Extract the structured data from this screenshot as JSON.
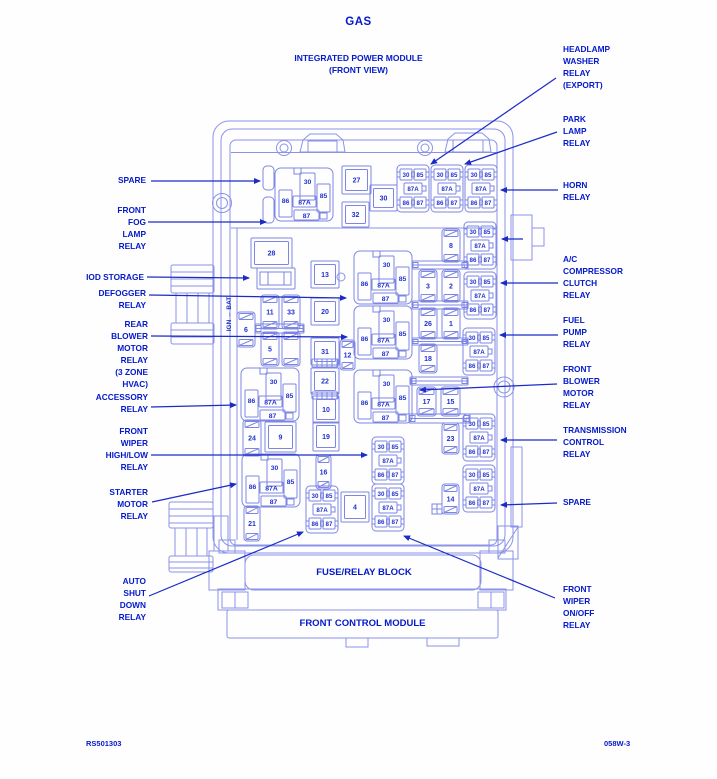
{
  "header": {
    "title": "GAS",
    "subtitle1": "INTEGRATED POWER MODULE",
    "subtitle2": "(FRONT VIEW)"
  },
  "panels": {
    "fuse_relay_block": "FUSE/RELAY BLOCK",
    "front_control_module": "FRONT CONTROL MODULE"
  },
  "footer": {
    "left": "RS501303",
    "right": "058W-3"
  },
  "colors": {
    "label_text": "#0419c9",
    "pin_text": "#2132cc",
    "line_light": "#8a93e6",
    "line_medium": "#7d86e3",
    "leader": "#1b2bc6",
    "background": "#fefeff"
  },
  "diagram": {
    "ign_bat_label": "IGN ↔ BAT",
    "left_labels": [
      {
        "id": "spare-left",
        "lines": [
          "SPARE"
        ],
        "x": 146,
        "y": 175,
        "leader": [
          151,
          181,
          260,
          181
        ]
      },
      {
        "id": "front-fog-lamp-relay",
        "lines": [
          "FRONT",
          "FOG",
          "LAMP",
          "RELAY"
        ],
        "x": 146,
        "y": 205,
        "leader": [
          148,
          222,
          266,
          222
        ]
      },
      {
        "id": "iod-storage",
        "lines": [
          "IOD STORAGE"
        ],
        "x": 144,
        "y": 272,
        "leader": [
          147,
          277,
          249,
          278
        ]
      },
      {
        "id": "defogger-relay",
        "lines": [
          "DEFOGGER",
          "RELAY"
        ],
        "x": 146,
        "y": 288,
        "leader": [
          149,
          295,
          346,
          298
        ]
      },
      {
        "id": "rear-blower-motor",
        "lines": [
          "REAR",
          "BLOWER",
          "MOTOR",
          "RELAY",
          "(3 ZONE",
          "HVAC)"
        ],
        "x": 148,
        "y": 319,
        "leader": [
          151,
          336,
          347,
          337
        ]
      },
      {
        "id": "accessory-relay",
        "lines": [
          "ACCESSORY",
          "RELAY"
        ],
        "x": 148,
        "y": 392,
        "leader": [
          151,
          407,
          236,
          405
        ]
      },
      {
        "id": "front-wiper-highlow",
        "lines": [
          "FRONT",
          "WIPER",
          "HIGH/LOW",
          "RELAY"
        ],
        "x": 148,
        "y": 426,
        "leader": [
          151,
          455,
          367,
          455
        ]
      },
      {
        "id": "starter-motor-relay",
        "lines": [
          "STARTER",
          "MOTOR",
          "RELAY"
        ],
        "x": 148,
        "y": 487,
        "leader": [
          152,
          502,
          236,
          484
        ]
      },
      {
        "id": "auto-shut-down-relay",
        "lines": [
          "AUTO",
          "SHUT",
          "DOWN",
          "RELAY"
        ],
        "x": 146,
        "y": 576,
        "leader": [
          149,
          596,
          303,
          532
        ]
      }
    ],
    "right_labels": [
      {
        "id": "headlamp-washer-relay",
        "lines": [
          "HEADLAMP",
          "WASHER",
          "RELAY",
          "(EXPORT)"
        ],
        "x": 563,
        "y": 44,
        "leader": [
          556,
          78,
          431,
          164
        ]
      },
      {
        "id": "park-lamp-relay",
        "lines": [
          "PARK",
          "LAMP",
          "RELAY"
        ],
        "x": 563,
        "y": 114,
        "leader": [
          557,
          132,
          465,
          164
        ]
      },
      {
        "id": "horn-relay",
        "lines": [
          "HORN",
          "RELAY"
        ],
        "x": 563,
        "y": 180,
        "leader": [
          558,
          190,
          501,
          190
        ]
      },
      {
        "id": "ac-compressor-clutch",
        "lines": [
          "A/C",
          "COMPRESSOR",
          "CLUTCH",
          "RELAY"
        ],
        "x": 563,
        "y": 254,
        "leader": [
          558,
          283,
          501,
          283
        ]
      },
      {
        "id": "fuel-pump-relay",
        "lines": [
          "FUEL",
          "PUMP",
          "RELAY"
        ],
        "x": 563,
        "y": 315,
        "leader": [
          558,
          335,
          500,
          335
        ]
      },
      {
        "id": "front-blower-motor",
        "lines": [
          "FRONT",
          "BLOWER",
          "MOTOR",
          "RELAY"
        ],
        "x": 563,
        "y": 364,
        "leader": [
          557,
          384,
          420,
          390
        ]
      },
      {
        "id": "transmission-control",
        "lines": [
          "TRANSMISSION",
          "CONTROL",
          "RELAY"
        ],
        "x": 563,
        "y": 425,
        "leader": [
          557,
          440,
          501,
          440
        ]
      },
      {
        "id": "spare-right",
        "lines": [
          "SPARE"
        ],
        "x": 563,
        "y": 497,
        "leader": [
          557,
          503,
          501,
          505
        ]
      },
      {
        "id": "front-wiper-onoff",
        "lines": [
          "FRONT",
          "WIPER",
          "ON/OFF",
          "RELAY"
        ],
        "x": 563,
        "y": 584,
        "leader": [
          555,
          598,
          404,
          536
        ]
      }
    ],
    "extra_leaders": [
      [
        523,
        239,
        502,
        239
      ]
    ],
    "square_fuses": [
      [
        "27",
        342,
        166,
        29,
        28
      ],
      [
        "32",
        342,
        202,
        27,
        25
      ],
      [
        "30",
        370,
        185,
        27,
        26
      ],
      [
        "28",
        251,
        238,
        41,
        30
      ],
      [
        "13",
        311,
        261,
        28,
        27
      ],
      [
        "20",
        311,
        298,
        28,
        27
      ],
      [
        "31",
        311,
        338,
        28,
        27
      ],
      [
        "22",
        311,
        368,
        28,
        26
      ],
      [
        "10",
        313,
        396,
        26,
        27
      ],
      [
        "19",
        313,
        422,
        26,
        29
      ],
      [
        "9",
        265,
        422,
        31,
        30
      ],
      [
        "4",
        341,
        492,
        28,
        30
      ]
    ],
    "blade_fuses": [
      [
        "11",
        261,
        295,
        18,
        34
      ],
      [
        "33",
        282,
        295,
        18,
        34
      ],
      [
        "6",
        237,
        312,
        18,
        35
      ],
      [
        "5",
        261,
        332,
        18,
        34
      ],
      [
        "",
        282,
        332,
        18,
        34
      ],
      [
        "8",
        442,
        229,
        18,
        33
      ],
      [
        "3",
        419,
        270,
        18,
        32
      ],
      [
        "2",
        442,
        270,
        18,
        32
      ],
      [
        "26",
        419,
        308,
        18,
        31
      ],
      [
        "1",
        442,
        308,
        18,
        31
      ],
      [
        "18",
        419,
        344,
        18,
        29
      ],
      [
        "17",
        417,
        387,
        19,
        29
      ],
      [
        "15",
        441,
        387,
        19,
        29
      ],
      [
        "23",
        442,
        423,
        17,
        31
      ],
      [
        "14",
        442,
        484,
        17,
        30
      ],
      [
        "12",
        340,
        340,
        15,
        30
      ],
      [
        "16",
        316,
        455,
        15,
        34
      ],
      [
        "24",
        243,
        420,
        18,
        36
      ],
      [
        "21",
        244,
        506,
        16,
        35
      ]
    ],
    "mini_relays": {
      "pins": [
        "30",
        "86",
        "87A",
        "85",
        "87"
      ],
      "positions": [
        [
          275,
          168
        ],
        [
          354,
          251
        ],
        [
          354,
          306
        ],
        [
          354,
          370
        ],
        [
          241,
          368
        ],
        [
          242,
          454
        ]
      ]
    },
    "micro_relays": {
      "rows": [
        [
          "30",
          "85"
        ],
        [
          "87A"
        ],
        [
          "86",
          "87"
        ]
      ],
      "positions": [
        [
          397,
          165
        ],
        [
          431,
          165
        ],
        [
          465,
          165
        ],
        [
          464,
          222
        ],
        [
          464,
          272
        ],
        [
          463,
          328
        ],
        [
          463,
          414
        ],
        [
          463,
          465
        ],
        [
          372,
          437
        ],
        [
          306,
          486
        ],
        [
          372,
          484
        ]
      ]
    },
    "bus_bars": [
      [
        412,
        261,
        56,
        8
      ],
      [
        412,
        301,
        56,
        8
      ],
      [
        412,
        338,
        56,
        7
      ],
      [
        410,
        377,
        58,
        8
      ],
      [
        409,
        414,
        61,
        9
      ],
      [
        255,
        324,
        49,
        9
      ]
    ],
    "ribbed_connectors": [
      [
        312,
        359,
        26,
        8
      ],
      [
        312,
        392,
        26,
        7
      ]
    ],
    "spare_slots": [
      [
        263,
        166,
        11,
        24
      ],
      [
        263,
        197,
        11,
        26
      ]
    ],
    "iod_connector": [
      257,
      268,
      38,
      21
    ],
    "small_circle": [
      341,
      277,
      4
    ],
    "cross_boxes": [
      [
        432,
        504,
        10,
        10
      ]
    ]
  }
}
